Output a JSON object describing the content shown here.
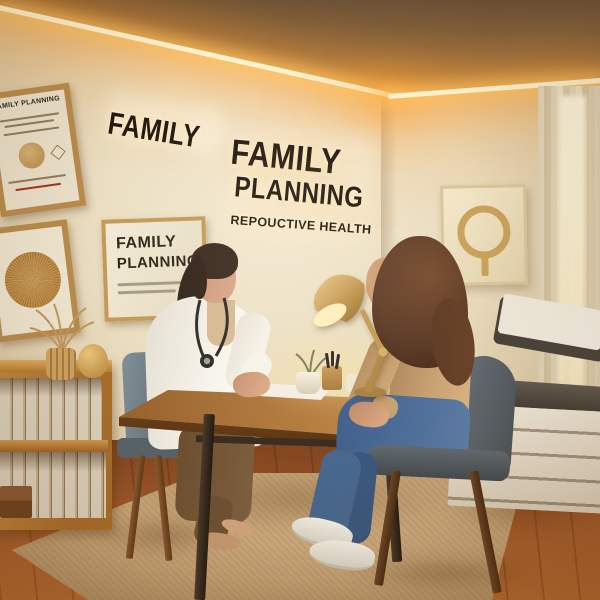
{
  "wall_signs": {
    "left_word": "FAMILY",
    "main_line1": "FAMILY",
    "main_line2": "PLANNING",
    "subtitle": "REPOUCTIVE HEALTH"
  },
  "wall_art": {
    "certificate_title": "AMILY PLANNING",
    "poster_line1": "FAMILY",
    "poster_line2": "PLANNING"
  },
  "colors": {
    "wall": "#e8dcc4",
    "ceiling": "#7d6447",
    "led_core": "#fff3cf",
    "led_glow": "#ffb84d",
    "sign_text": "#241a10",
    "frame_wood": "#b98c4c",
    "shelf_wood": "#a86d2a",
    "desk_wood": "#b87f40",
    "wood_floor": "#a25a2a",
    "rug": "#c7a377",
    "brass": "#b68538",
    "coat_white": "#f7f4ec",
    "sweater_tan": "#c7a172",
    "jeans_blue": "#4f6f9a",
    "chair_gray": "#5f6b71",
    "chair_dark": "#4c545a",
    "exam_pad": "#4a433c",
    "exam_base": "#ddd2bc",
    "paper_white": "#f6f0e2",
    "skin": "#dca98a",
    "hair_dark": "#33231a",
    "hair_brown": "#5d3b26"
  }
}
